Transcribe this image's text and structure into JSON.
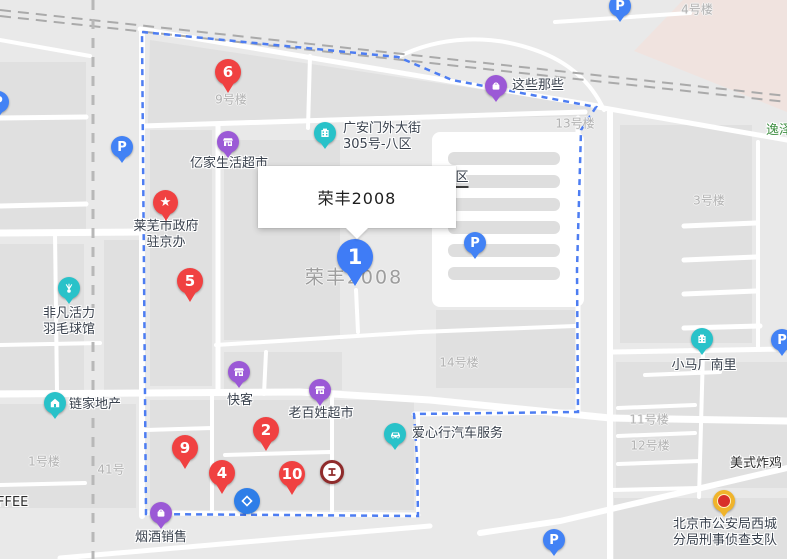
{
  "info_box": {
    "title": "荣丰2008"
  },
  "selected_place": {
    "marker_number": "1",
    "map_label": "荣丰2008"
  },
  "red_markers": [
    {
      "number": "6"
    },
    {
      "number": "5"
    },
    {
      "number": "2"
    },
    {
      "number": "4"
    },
    {
      "number": "9"
    },
    {
      "number": "10"
    }
  ],
  "parking_label": "P",
  "icons": {
    "star": "★"
  },
  "pois": [
    {
      "label": "这些那些"
    },
    {
      "line1": "广安门外大街",
      "line2": "305号-八区"
    },
    {
      "label": "亿家生活超市"
    },
    {
      "line1": "莱芜市政府",
      "line2": "驻京办"
    },
    {
      "line1": "非凡活力",
      "line2": "羽毛球馆"
    },
    {
      "label": "链家地产"
    },
    {
      "label": "快客"
    },
    {
      "label": "老百姓超市"
    },
    {
      "label": "爱心行汽车服务"
    },
    {
      "label": "烟酒销售"
    },
    {
      "label": "小马厂南里"
    },
    {
      "label": "美式炸鸡"
    },
    {
      "line1": "北京市公安局西城",
      "line2": "分局刑事侦查支队"
    },
    {
      "label": "逸泽"
    },
    {
      "label": "区"
    },
    {
      "label": "FFEE"
    }
  ],
  "buildings": [
    "9号楼",
    "4号楼",
    "13号楼",
    "3号楼",
    "14号楼",
    "11号楼",
    "12号楼",
    "1号楼",
    "41号"
  ],
  "colors": {
    "boundary_blue": "#4d7df2",
    "marker_red": "#f04141",
    "marker_blue": "#3f7cf6",
    "parking_blue": "#4282f5",
    "poi_purple": "#9b59d6",
    "poi_teal": "#29c2c9",
    "icbc_red": "#8f2b2b",
    "police_gold": "#f0b42b",
    "bank_blue": "#2e7ee8",
    "green_label": "#3e8e41",
    "pink_block": "#f0e3df"
  }
}
